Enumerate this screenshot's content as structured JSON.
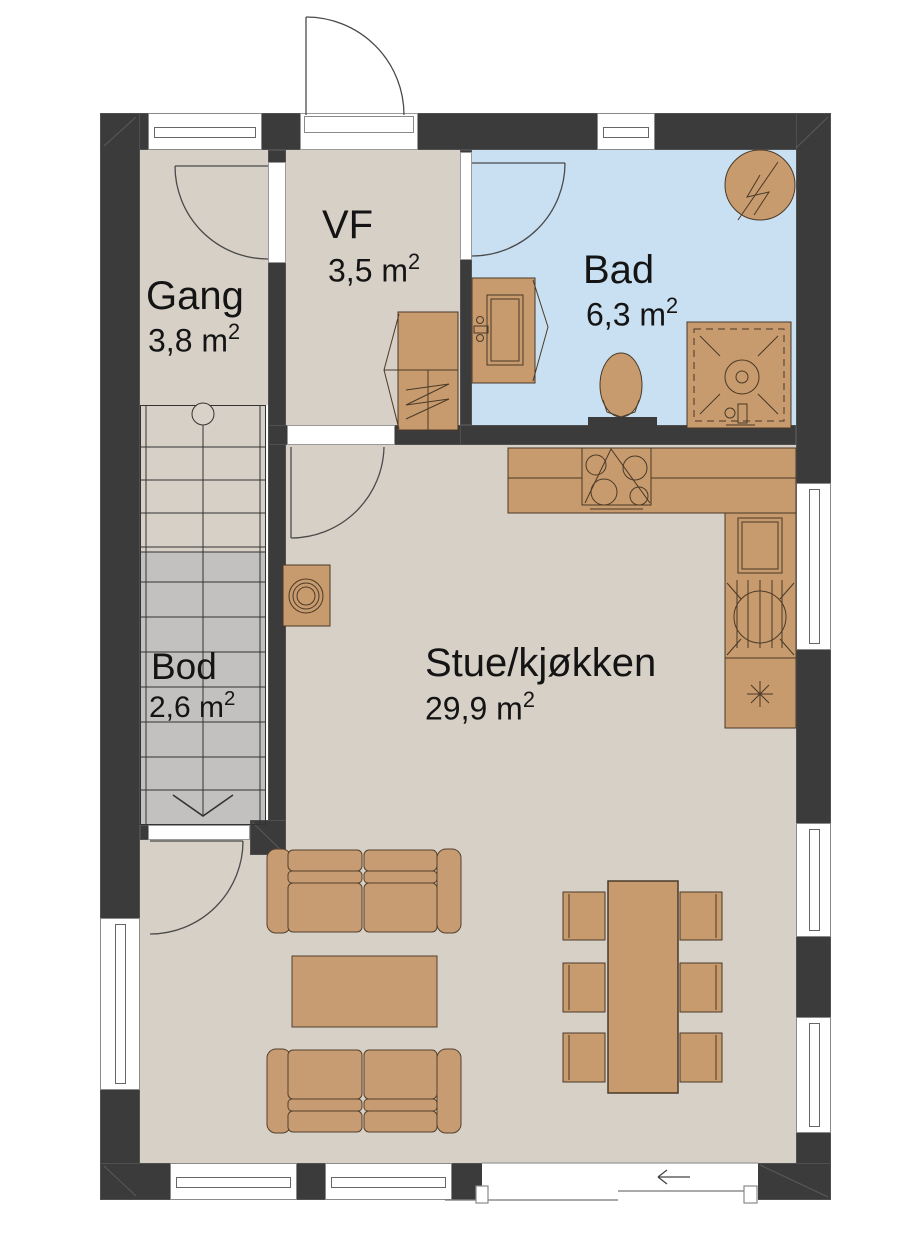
{
  "plan": {
    "type": "floor-plan",
    "rooms": {
      "gang": {
        "name": "Gang",
        "area": "3,8 m",
        "area_sup": "2"
      },
      "vf": {
        "name": "VF",
        "area": "3,5 m",
        "area_sup": "2"
      },
      "bad": {
        "name": "Bad",
        "area": "6,3 m",
        "area_sup": "2"
      },
      "bod": {
        "name": "Bod",
        "area": "2,6 m",
        "area_sup": "2"
      },
      "stue": {
        "name": "Stue/kjøkken",
        "area": "29,9 m",
        "area_sup": "2"
      }
    },
    "icons": {
      "sliding_door_arrow": "←",
      "dishwasher_mark": "asterisk",
      "water_heater": "lightning-bolt-in-circle"
    },
    "colors": {
      "wall": "#3b3b3b",
      "floor": "#d7d0c7",
      "bathroom_floor": "#c9e0f2",
      "storage_floor": "#c2c1bf",
      "furniture": "#c79b6e",
      "furniture_outline": "#4a3a28"
    }
  }
}
